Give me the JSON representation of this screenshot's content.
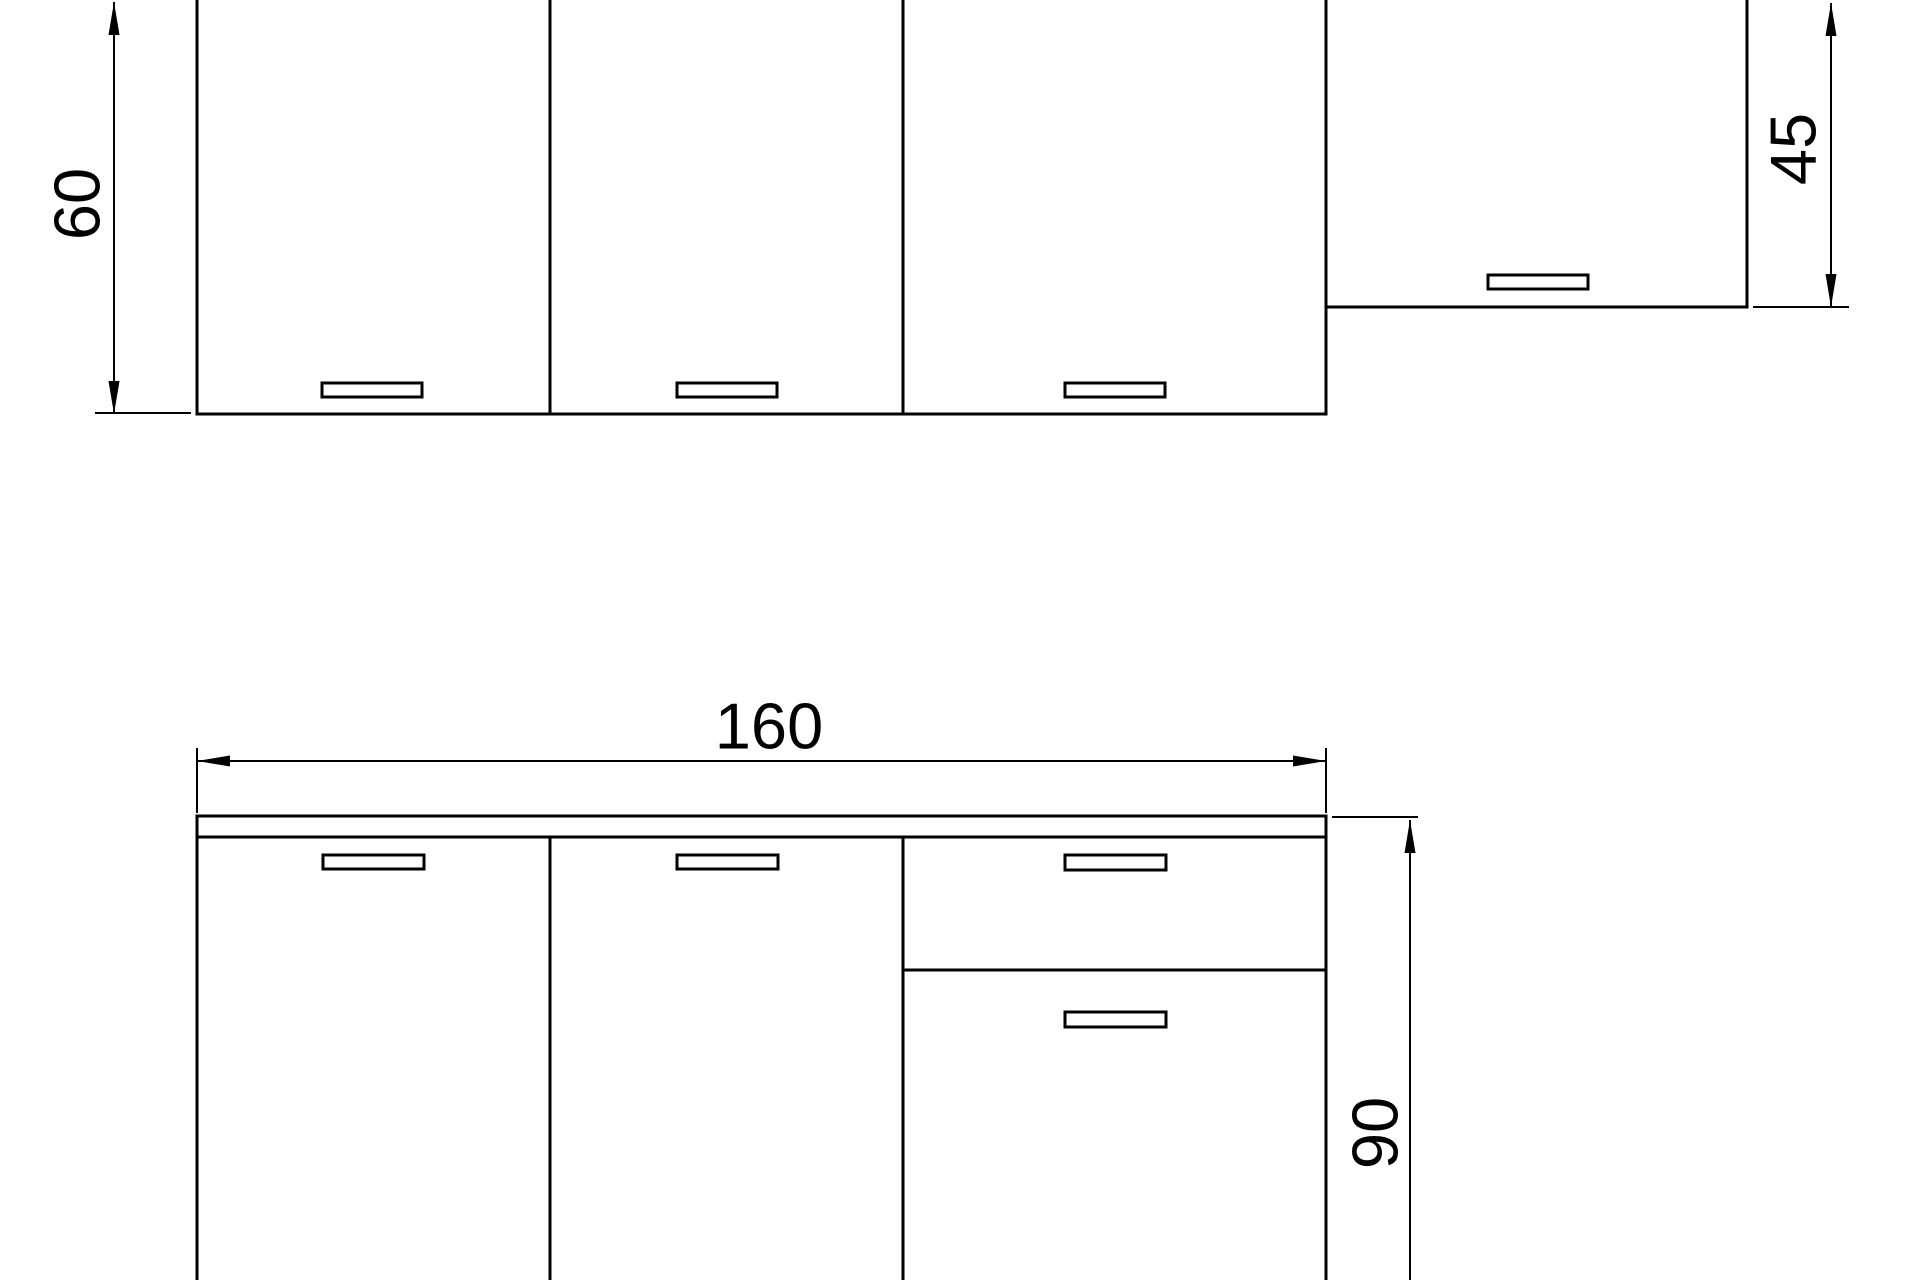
{
  "page": {
    "background_color": "#ffffff",
    "description": "Technical elevation drawing of a kitchen cabinet set with dimension annotations (units in cm)"
  },
  "drawing": {
    "stroke_color": "#000000",
    "fill_color": "#ffffff",
    "text_color": "#000000",
    "font_size_px": 65,
    "canvas": {
      "width": 1920,
      "height": 1280
    },
    "rects": [
      {
        "name": "wall-cabinet-1",
        "x": 197,
        "y": -10,
        "w": 353,
        "h": 424,
        "sw": 3
      },
      {
        "name": "wall-cabinet-2",
        "x": 550,
        "y": -10,
        "w": 353,
        "h": 424,
        "sw": 3
      },
      {
        "name": "wall-cabinet-3",
        "x": 903,
        "y": -10,
        "w": 423,
        "h": 424,
        "sw": 3
      },
      {
        "name": "wall-cabinet-short",
        "x": 1326,
        "y": -10,
        "w": 421,
        "h": 317,
        "sw": 3
      },
      {
        "name": "wall-cabinet-1-handle",
        "x": 322,
        "y": 383,
        "w": 100,
        "h": 14,
        "sw": 3
      },
      {
        "name": "wall-cabinet-2-handle",
        "x": 677,
        "y": 383,
        "w": 100,
        "h": 14,
        "sw": 3
      },
      {
        "name": "wall-cabinet-3-handle",
        "x": 1065,
        "y": 383,
        "w": 100,
        "h": 14,
        "sw": 3
      },
      {
        "name": "wall-cabinet-short-handle",
        "x": 1488,
        "y": 275,
        "w": 100,
        "h": 14,
        "sw": 3
      },
      {
        "name": "countertop",
        "x": 197,
        "y": 816,
        "w": 1129,
        "h": 21,
        "sw": 3
      },
      {
        "name": "base-cabinet-body",
        "x": 197,
        "y": 837,
        "w": 1129,
        "h": 455,
        "sw": 3
      },
      {
        "name": "base-door-1-handle",
        "x": 323,
        "y": 855,
        "w": 101,
        "h": 14,
        "sw": 3
      },
      {
        "name": "base-door-2-handle",
        "x": 677,
        "y": 855,
        "w": 101,
        "h": 14,
        "sw": 3
      },
      {
        "name": "base-drawer-handle",
        "x": 1065,
        "y": 855,
        "w": 101,
        "h": 15,
        "sw": 3
      },
      {
        "name": "base-door-3-handle",
        "x": 1065,
        "y": 1012,
        "w": 101,
        "h": 15,
        "sw": 3
      }
    ],
    "lines": [
      {
        "name": "base-divider-1",
        "x1": 550,
        "y1": 837,
        "x2": 550,
        "y2": 1292,
        "sw": 3
      },
      {
        "name": "base-divider-2",
        "x1": 903,
        "y1": 837,
        "x2": 903,
        "y2": 1292,
        "sw": 3
      },
      {
        "name": "base-drawer-bottom",
        "x1": 903,
        "y1": 970,
        "x2": 1326,
        "y2": 970,
        "sw": 3
      }
    ],
    "dimensions": [
      {
        "name": "dim-wall-cabinet-height",
        "label": "60",
        "line": {
          "x1": 114,
          "y1": 2,
          "x2": 114,
          "y2": 414,
          "sw": 2
        },
        "arrows": [
          {
            "x": 114,
            "y": 2,
            "dir": "up"
          },
          {
            "x": 114,
            "y": 414,
            "dir": "down"
          }
        ],
        "ext_lines": [
          {
            "x1": 95,
            "y1": 413,
            "x2": 191,
            "y2": 413,
            "sw": 2
          }
        ],
        "text": {
          "x": 77,
          "y": 204,
          "rotate": -90
        }
      },
      {
        "name": "dim-wall-cabinet-short-height",
        "label": "45",
        "line": {
          "x1": 1831,
          "y1": 3,
          "x2": 1831,
          "y2": 307,
          "sw": 2
        },
        "arrows": [
          {
            "x": 1831,
            "y": 3,
            "dir": "up"
          },
          {
            "x": 1831,
            "y": 307,
            "dir": "down"
          }
        ],
        "ext_lines": [
          {
            "x1": 1753,
            "y1": 307,
            "x2": 1849,
            "y2": 307,
            "sw": 2
          }
        ],
        "text": {
          "x": 1793,
          "y": 149,
          "rotate": -90
        }
      },
      {
        "name": "dim-base-width",
        "label": "160",
        "line": {
          "x1": 197,
          "y1": 761,
          "x2": 1326,
          "y2": 761,
          "sw": 2
        },
        "arrows": [
          {
            "x": 197,
            "y": 761,
            "dir": "left"
          },
          {
            "x": 1326,
            "y": 761,
            "dir": "right"
          }
        ],
        "ext_lines": [
          {
            "x1": 197,
            "y1": 748,
            "x2": 197,
            "y2": 813,
            "sw": 2
          },
          {
            "x1": 1326,
            "y1": 748,
            "x2": 1326,
            "y2": 813,
            "sw": 2
          }
        ],
        "text": {
          "x": 769,
          "y": 726,
          "rotate": 0
        }
      },
      {
        "name": "dim-base-height",
        "label": "90",
        "line": {
          "x1": 1410,
          "y1": 820,
          "x2": 1410,
          "y2": 1285,
          "sw": 2
        },
        "arrows": [
          {
            "x": 1410,
            "y": 820,
            "dir": "up"
          }
        ],
        "ext_lines": [
          {
            "x1": 1332,
            "y1": 817,
            "x2": 1418,
            "y2": 817,
            "sw": 2
          }
        ],
        "text": {
          "x": 1375,
          "y": 1133,
          "rotate": -90
        }
      }
    ]
  }
}
